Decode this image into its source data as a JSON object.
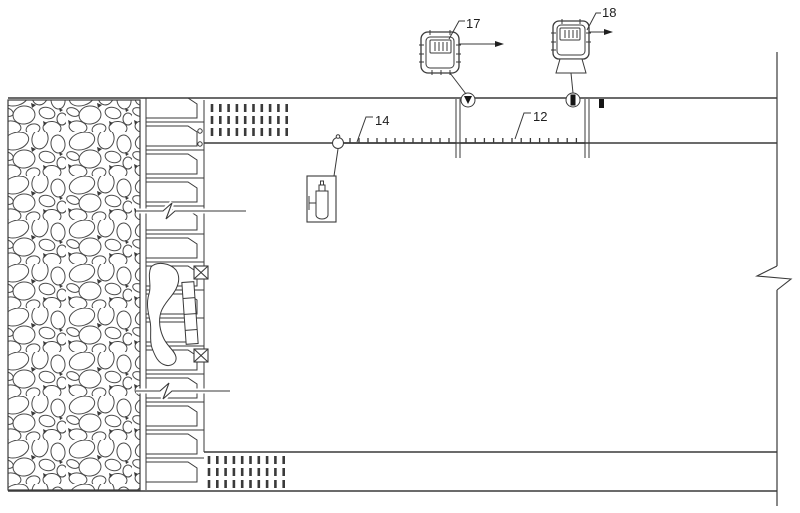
{
  "figure": {
    "kind": "patent-style mine roadway section drawing",
    "background": "#ffffff",
    "line_color": "#3a3a3a",
    "text_color": "#1f1f1f"
  },
  "callouts": {
    "c17": "17",
    "c18": "18",
    "c14": "14",
    "c12": "12"
  },
  "icons": {
    "monitor17": "wireless-monitor-with-display-and-antenna",
    "monitor18": "wireless-monitor-with-display-and-antenna",
    "valve_a": "circle-with-down-triangle",
    "valve_b": "circle-with-bar",
    "cylinder": "gas-cylinder-in-box",
    "rock": "rubble-gravel-hatch",
    "break": "zigzag-break-line"
  }
}
